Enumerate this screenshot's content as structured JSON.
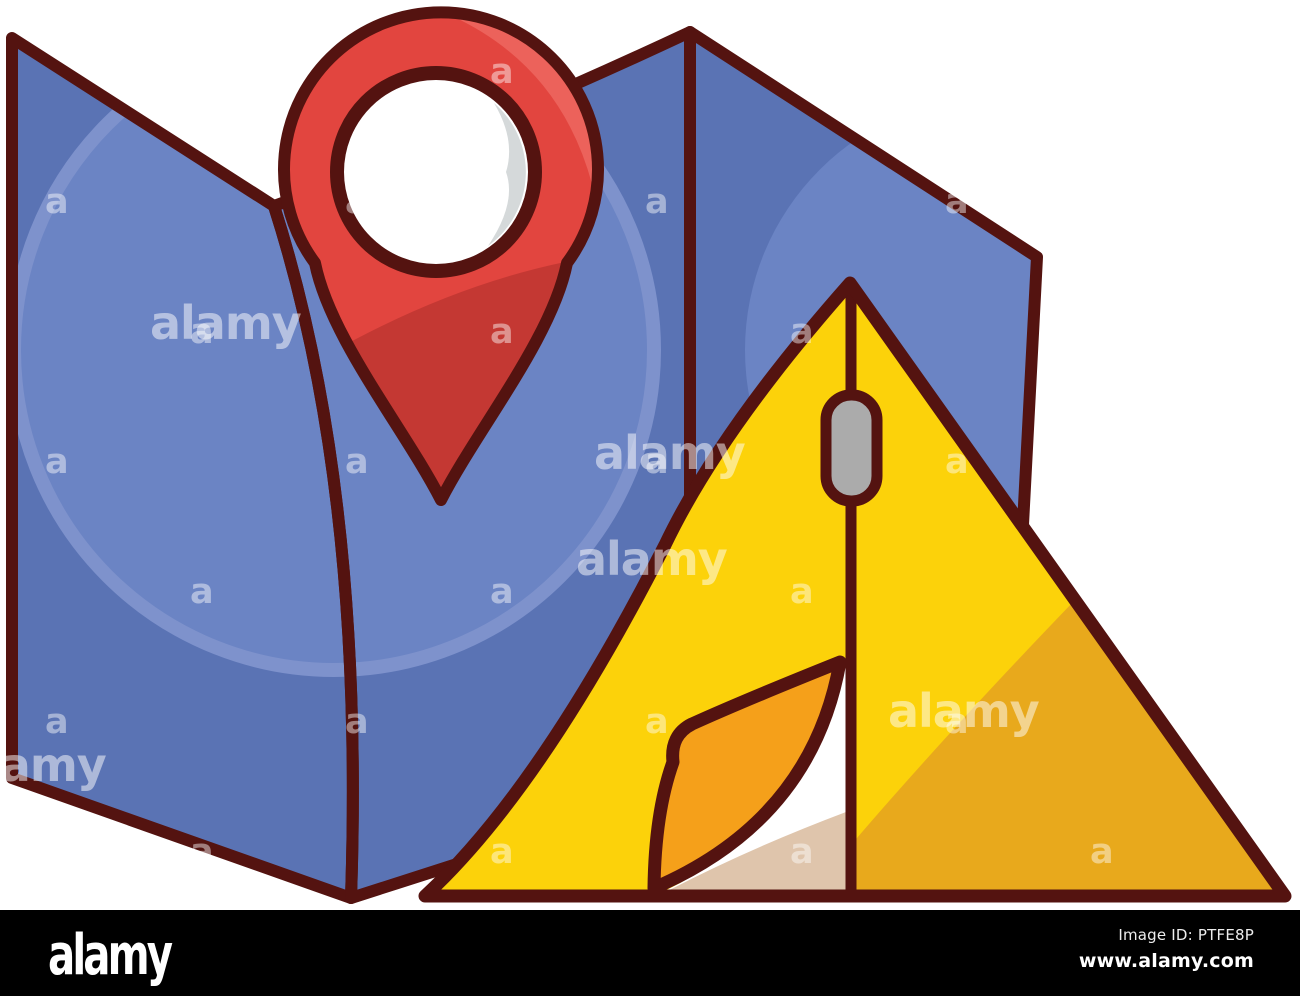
{
  "artwork": {
    "background": "#ffffff",
    "outline_color": "#541310",
    "map": {
      "name": "folded paper map",
      "panel_fill": "#5A73B4",
      "circle_fill": "#6B84C4",
      "circle_rim": "#7E92CC"
    },
    "pin": {
      "name": "location pin",
      "red": "#E2453F",
      "shadow_red": "#C43833",
      "highlight_red": "#EC625B",
      "ring_fill": "#FFFFFF",
      "inner_shadow": "#D5D9DA"
    },
    "tent": {
      "name": "camping tent",
      "front_fill": "#FCD20A",
      "side_fill": "#E8A91C",
      "flap_fill": "#F5A01A",
      "floor_fill": "#DFC5AC",
      "wall_fill": "#FFFFFF",
      "zipper_fill": "#ABABAB"
    }
  },
  "watermark": {
    "brand_text": "alamy",
    "letter_text": "a",
    "color": "#ffffff",
    "brand_opacity": 0.5,
    "letter_opacity": 0.45,
    "brand_tiles": [
      {
        "x": 150,
        "y": 300
      },
      {
        "x": 594,
        "y": 430
      },
      {
        "x": 576,
        "y": 536
      },
      {
        "x": 888,
        "y": 688
      },
      {
        "x": -45,
        "y": 742
      }
    ],
    "letter_grid": {
      "row_start": 55,
      "row_step": 130,
      "row_count": 7,
      "col_step": 300,
      "row_offsets": [
        190,
        45
      ]
    }
  },
  "footer_bar": {
    "background": "#000000",
    "logo_text": "alamy",
    "image_id_label": "Image ID: PTFE8P",
    "website_url": "www.alamy.com"
  }
}
